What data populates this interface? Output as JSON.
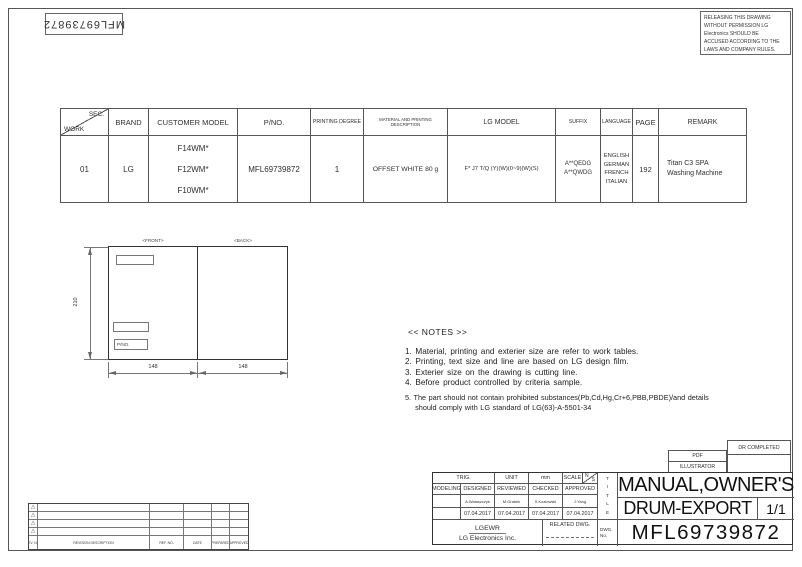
{
  "top_left_label": {
    "doc_no": "MFL69739872"
  },
  "warning_box": {
    "text": "RELEASING THIS DRAWING\nWITHOUT PERMISSION LG\nElectronics SHOULD BE\nACCUSED ACCORDING TO THE\nLAWS AND COMPANY RULES."
  },
  "work_table": {
    "header": {
      "sec": "SEC.",
      "work": "WORK",
      "brand": "BRAND",
      "customer_model": "CUSTOMER MODEL",
      "pno": "P/NO.",
      "printing_degree": "PRINTING DEGREE",
      "material": "MATERIAL AND PRINTING DESCRIPTION",
      "lg_model": "LG MODEL",
      "suffix": "SUFFIX",
      "language": "LANGUAGE",
      "page": "PAGE",
      "remark": "REMARK"
    },
    "row": {
      "work": "01",
      "brand": "LG",
      "customer_model": "F14WM*\nF12WM*\nF10WM*",
      "pno": "MFL69739872",
      "printing_degree": "1",
      "material": "OFFSET WHITE 80 g",
      "lg_model": "F* J7 T/Q (Y)(W)(0~9)(W)(S)",
      "suffix": "A**QEDG\nA**QWDG",
      "language": "ENGLISH\nGERMAN\nFRENCH\nITALIAN",
      "page": "192",
      "remark": "Titan C3 SPA\nWashing Machine"
    }
  },
  "drawing": {
    "front_label": "<FRONT>",
    "back_label": "<BACK>",
    "pno_label": "P/NO.",
    "dim_height": "210",
    "dim_width_front": "148",
    "dim_width_back": "148"
  },
  "notes": {
    "title": "<< NOTES >>",
    "items": [
      "1. Material, printing and exterier size are refer to work tables.",
      "2. Printing, text size and line are based on LG design film.",
      "3. Exterier size on the drawing is cutting line.",
      "4. Before product controlled by criteria sample.",
      "5. The part should not contain prohibited substances(Pb,Cd,Hg,Cr+6,PBB,PBDE)/and details",
      "    should comply with LG standard of LG(63)-A-5501-34"
    ]
  },
  "output_boxes": {
    "pdf": "PDF",
    "illustrator": "ILLUSTRATOR",
    "dr_completed": "DR COMPLETED"
  },
  "title_block": {
    "trig": "TRIG.",
    "unit_label": "UNIT",
    "unit_value": "mm",
    "scale_label": "SCALE",
    "scale_n": "N",
    "scale_s": "S",
    "modeling": "MODELING",
    "designed": "DESIGNED",
    "reviewed": "REVIEWED",
    "checked": "CHECKED",
    "approved": "APPROVED",
    "designed_name": "A.Walaszczyk",
    "reviewed_name": "M.Grabek",
    "checked_name": "S.Kozlowski",
    "approved_name": "J.Yang",
    "designed_date": "07.04.2017",
    "reviewed_date": "07.04.2017",
    "checked_date": "07.04.2017",
    "approved_date": "07.04.2017",
    "company_short": "LGEWR",
    "company_full": "LG Electronics Inc.",
    "related_dwg": "RELATED DWG.",
    "title_vertical": "T\nI\nT\nL\nE",
    "dwg_no_label": "DWG.\nNo.",
    "title_line1": "MANUAL,OWNER'S",
    "title_line2": "DRUM-EXPORT",
    "sheet_count": "1/1",
    "drawing_number": "MFL69739872"
  },
  "revision_table": {
    "delta_icon": "△",
    "rev_no": "REV. NO.",
    "description": "REVISION DESCRIPTION",
    "ref_no": "REF. NO.",
    "date": "DATE",
    "prepared": "PREPARED",
    "approved": "APPROVED"
  }
}
